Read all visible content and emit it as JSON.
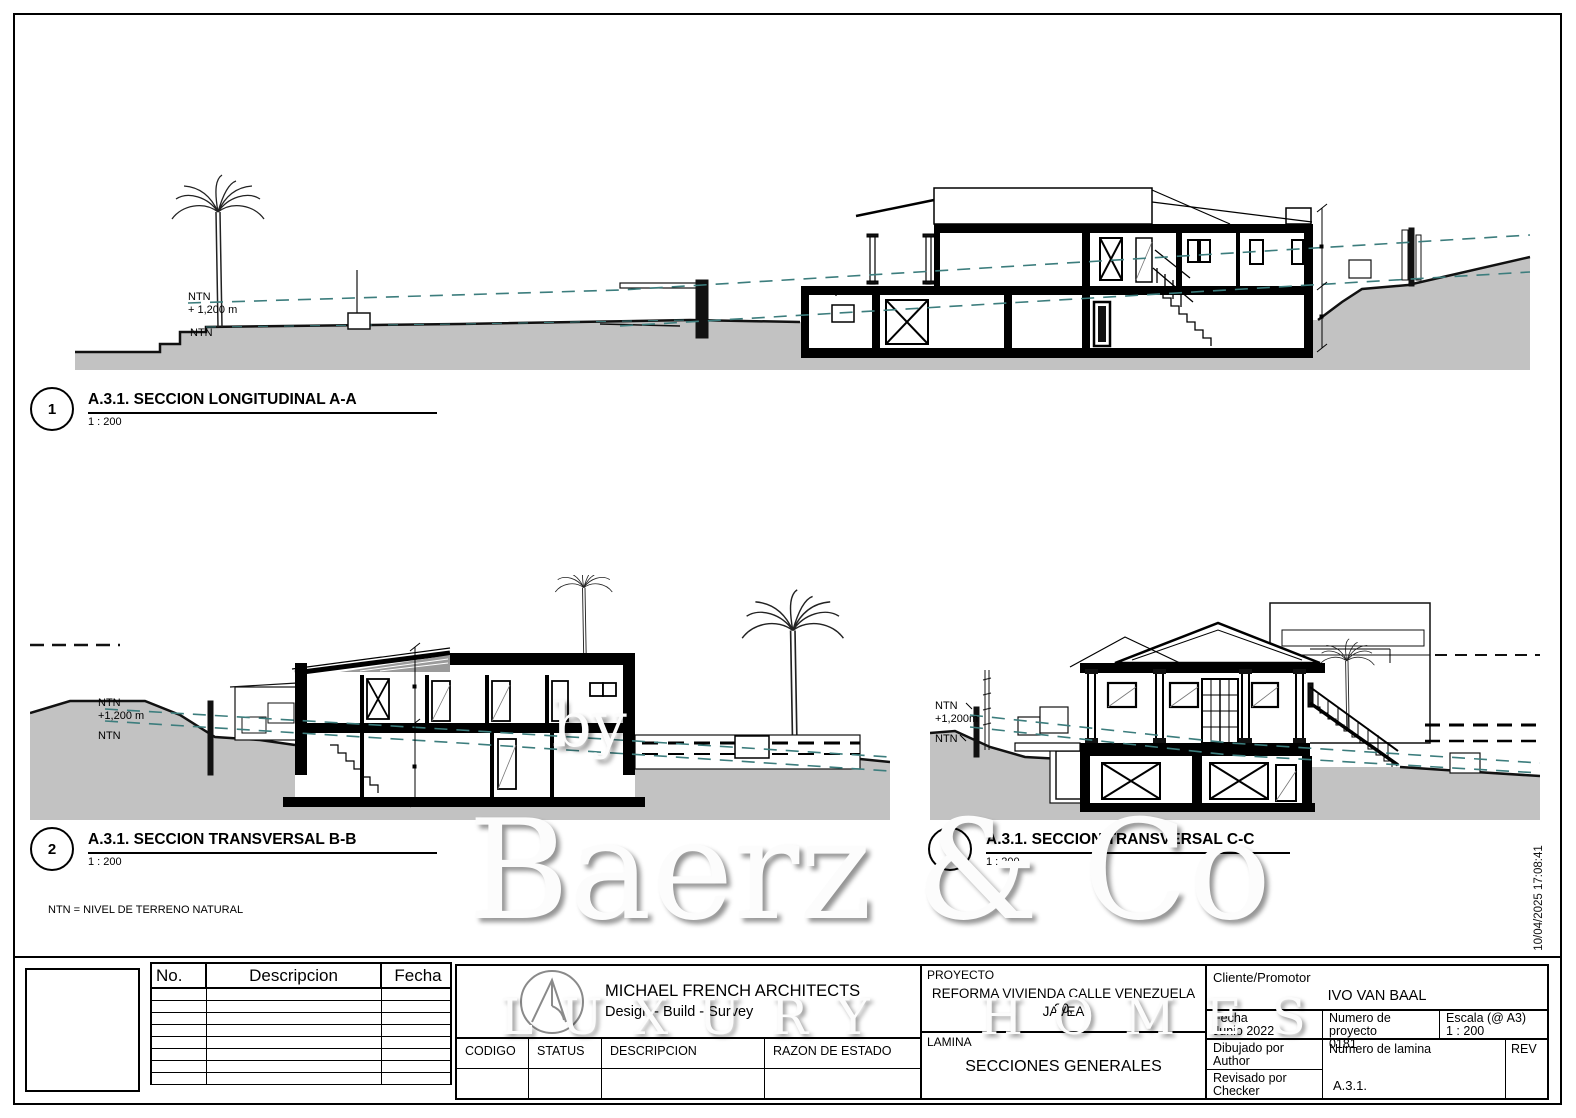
{
  "sheet": {
    "timestamp": "10/04/2025 17:08:41",
    "note": "NTN = NIVEL DE TERRENO NATURAL"
  },
  "watermark": {
    "by": "by",
    "name": "Baerz & Co",
    "subtitle": "LUXURY HOMES"
  },
  "sections": [
    {
      "num": "1",
      "title": "A.3.1. SECCION LONGITUDINAL A-A",
      "scale": "1 : 200",
      "ntn": "NTN",
      "ntn_elev": "+ 1,200 m",
      "ntn2": "NTN"
    },
    {
      "num": "2",
      "title": "A.3.1. SECCION TRANSVERSAL B-B",
      "scale": "1 : 200",
      "ntn": "NTN",
      "ntn_elev": "+1,200 m",
      "ntn2": "NTN"
    },
    {
      "num": "3",
      "title": "A.3.1. SECCION TRANSVERSAL C-C",
      "scale": "1 : 200",
      "ntn": "NTN",
      "ntn_elev": "+1,200m",
      "ntn2": "NTN"
    }
  ],
  "title_block": {
    "revisions": {
      "no": "No.",
      "desc": "Descripcion",
      "fecha": "Fecha"
    },
    "architect": {
      "name": "MICHAEL FRENCH ARCHITECTS",
      "tagline": "Design - Build - Survey",
      "codigo": "CODIGO",
      "status": "STATUS",
      "descripcion": "DESCRIPCION",
      "razon": "RAZON DE ESTADO"
    },
    "project": {
      "label": "PROYECTO",
      "line1": "REFORMA VIVIENDA CALLE VENEZUELA 20,",
      "line2": "JAVEA",
      "sheet_label": "LAMINA",
      "sheet_title": "SECCIONES GENERALES"
    },
    "info": {
      "client_label": "Cliente/Promotor",
      "client": "IVO VAN BAAL",
      "date_label": "Fecha",
      "date": "Junio 2022",
      "proj_no_label": "Numero de proyecto",
      "proj_no": "0181",
      "scale_label": "Escala (@ A3)",
      "scale": "1 : 200",
      "drawn_label": "Dibujado por",
      "drawn": "Author",
      "checked_label": "Revisado por",
      "checked": "Checker",
      "sheet_no_label": "Numero de lamina",
      "sheet_no": "A.3.1.",
      "rev_label": "REV"
    }
  },
  "colors": {
    "terrain": "#c2c2c2",
    "ntn_dash": "#3c7d7d",
    "ink": "#000000"
  }
}
